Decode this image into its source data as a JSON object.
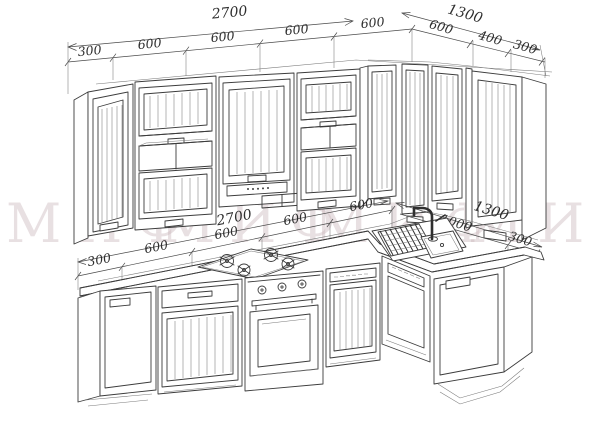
{
  "watermark": {
    "text": "МИФ",
    "color": "#c9b4ba"
  },
  "drawing": {
    "type": "kitchen-elevation",
    "line_color": "#3c3c3c",
    "background": "#ffffff"
  },
  "dimensions": {
    "upper_row": {
      "left_total": "2700",
      "left_segments": [
        "300",
        "600",
        "600",
        "600",
        "600"
      ],
      "right_total": "1300",
      "right_segments": [
        "600",
        "400",
        "300"
      ]
    },
    "base_row": {
      "left_total": "2700",
      "left_segments": [
        "300",
        "600",
        "600",
        "600",
        "600"
      ],
      "right_total": "1300",
      "right_segments": [
        "1000",
        "300"
      ]
    }
  }
}
